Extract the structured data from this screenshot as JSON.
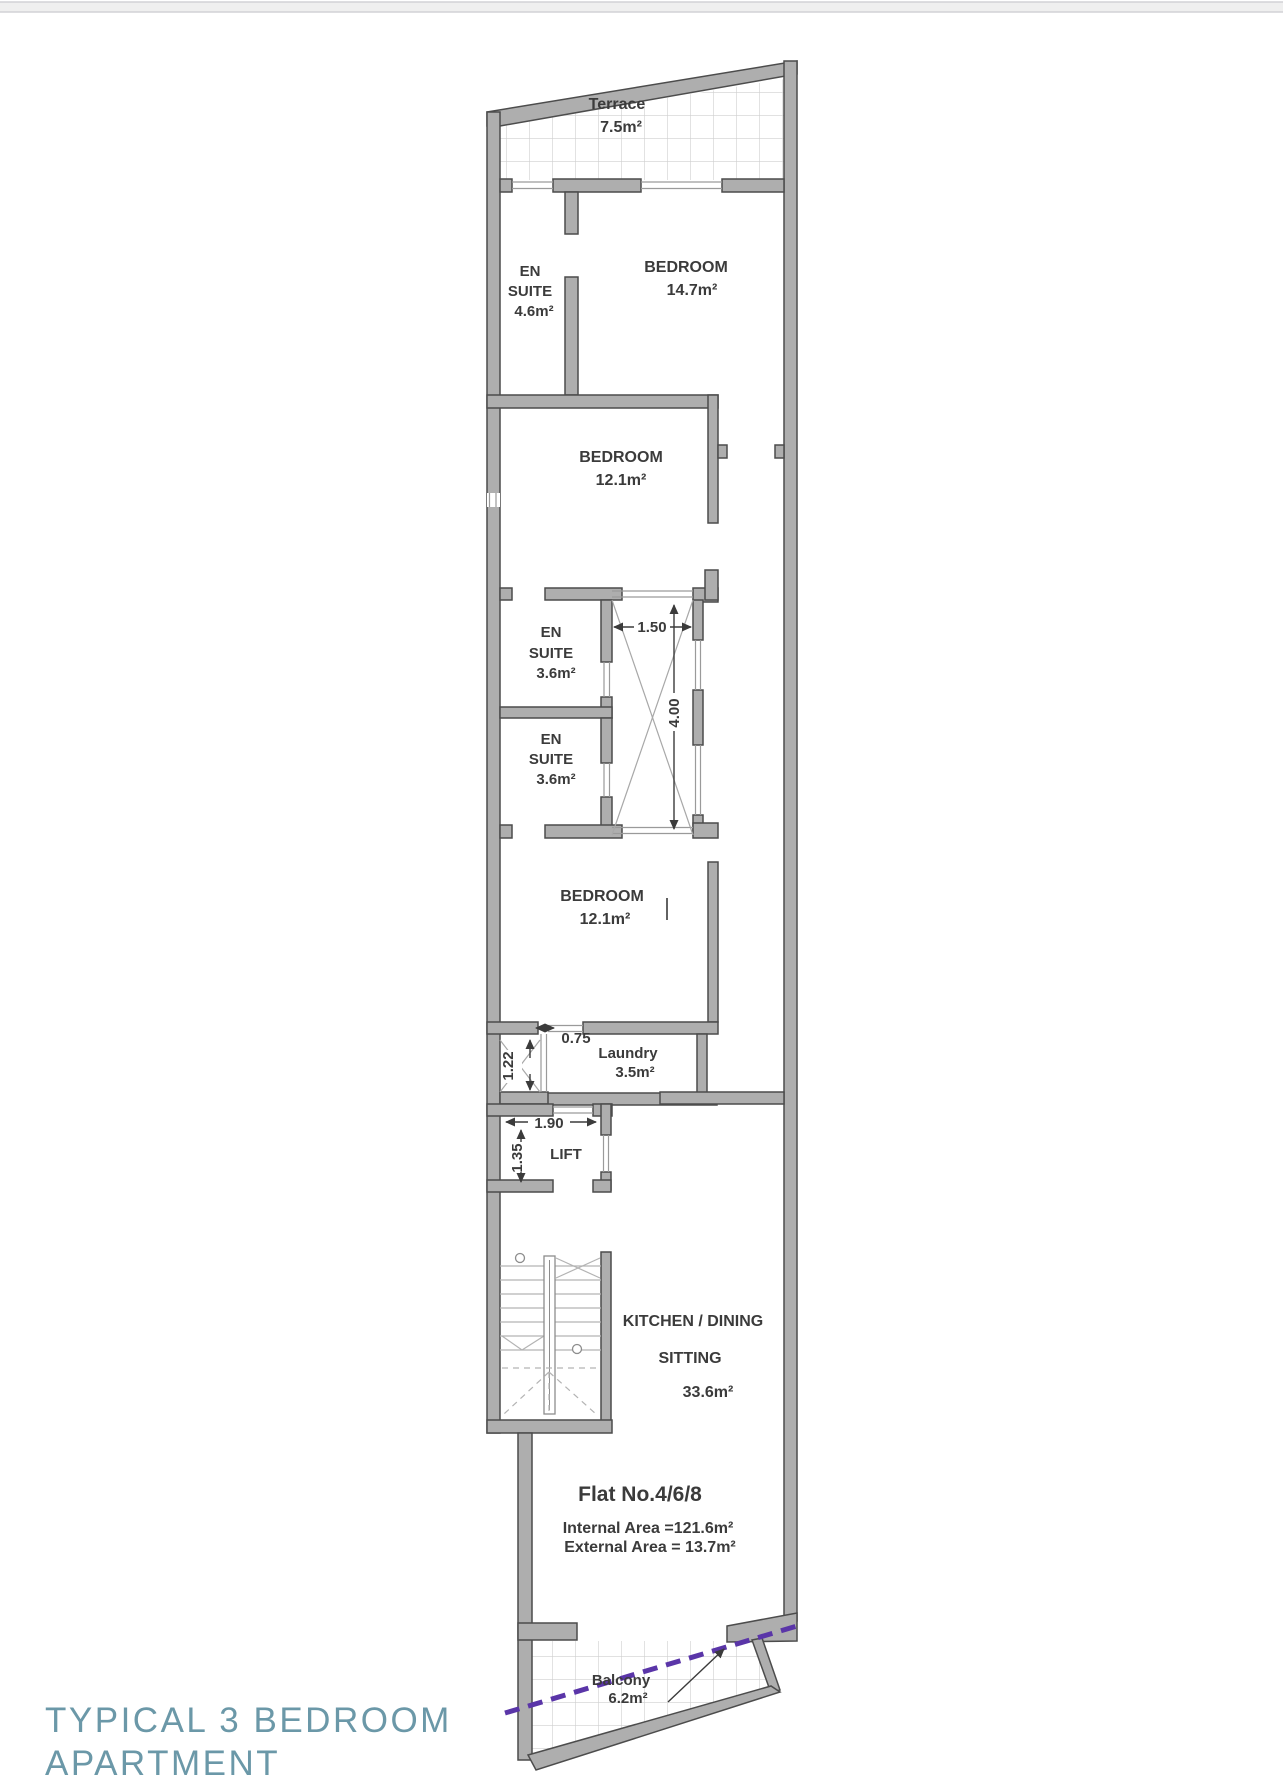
{
  "plan": {
    "rooms": {
      "terrace": {
        "name": "Terrace",
        "area": "7.5m²"
      },
      "ensuite_top": {
        "l1": "EN",
        "l2": "SUITE",
        "area": "4.6m²"
      },
      "bedroom_top": {
        "name": "BEDROOM",
        "area": "14.7m²"
      },
      "bedroom_mid": {
        "name": "BEDROOM",
        "area": "12.1m²"
      },
      "ensuite_a": {
        "l1": "EN",
        "l2": "SUITE",
        "area": "3.6m²"
      },
      "ensuite_b": {
        "l1": "EN",
        "l2": "SUITE",
        "area": "3.6m²"
      },
      "bedroom_low": {
        "name": "BEDROOM",
        "area": "12.1m²"
      },
      "laundry": {
        "name": "Laundry",
        "area": "3.5m²"
      },
      "lift": {
        "name": "LIFT"
      },
      "kitchen": {
        "l1": "KITCHEN / DINING",
        "l2": "SITTING",
        "area": "33.6m²"
      },
      "balcony": {
        "name": "Balcony",
        "area": "6.2m²"
      }
    },
    "dimensions": {
      "shaft_width": "1.50",
      "shaft_height": "4.00",
      "duct_width": "0.75",
      "duct_height": "1.22",
      "lift_width": "1.90",
      "lift_height": "1.35"
    },
    "flat_info": {
      "number": "Flat No.4/6/8",
      "internal": "Internal Area =121.6m²",
      "external": "External Area = 13.7m²"
    }
  },
  "footer": {
    "title_line1": "TYPICAL 3 BEDROOM",
    "title_line2": "APARTMENT"
  },
  "colors": {
    "wall": "#aeaeae",
    "wall_outline": "#4c4c4c",
    "boundary_line": "#5a35a8",
    "title": "#6b98a8",
    "text": "#3b3b3b"
  }
}
